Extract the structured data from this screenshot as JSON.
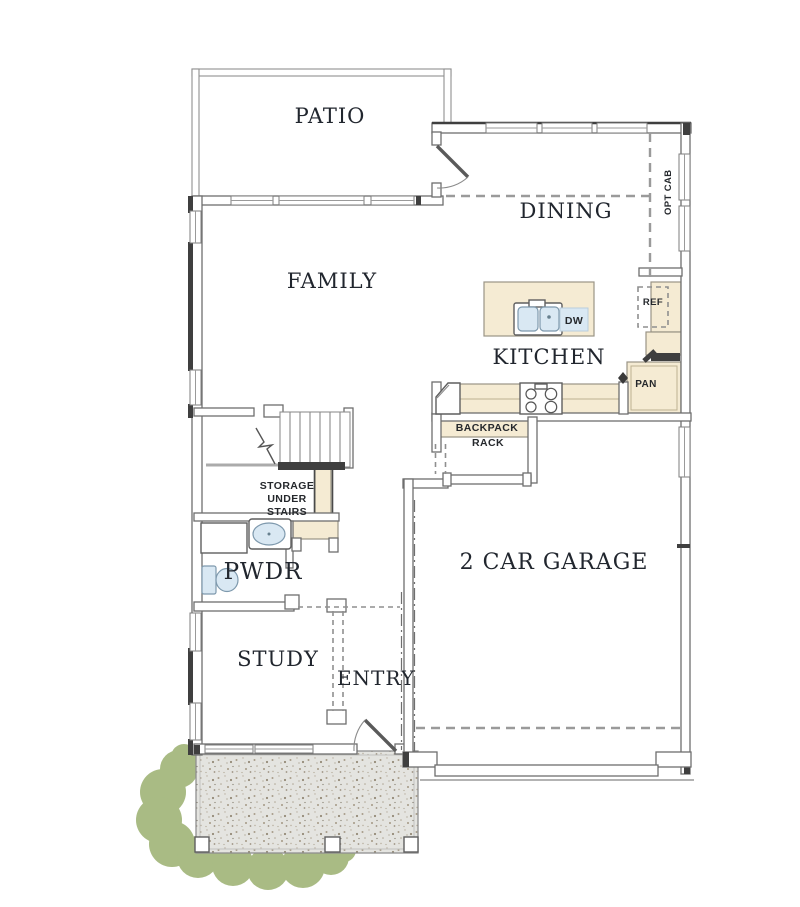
{
  "plan": {
    "rooms": {
      "patio": "PATIO",
      "dining": "DINING",
      "family": "FAMILY",
      "kitchen": "KITCHEN",
      "garage": "2 CAR GARAGE",
      "study": "STUDY",
      "entry": "ENTRY",
      "powder": "PWDR"
    },
    "labels": {
      "storage_line1": "STORAGE",
      "storage_line2": "UNDER",
      "storage_line3": "STAIRS",
      "backpack_line1": "BACKPACK",
      "backpack_line2": "RACK",
      "ref": "REF",
      "pan": "PAN",
      "dw": "DW",
      "opt_cab": "OPT CAB"
    },
    "colors": {
      "cabinet_fill": "#f5ebd3",
      "fixture_blue": "#d9e8f3",
      "porch_concrete": "#e4e4e0",
      "shrub_green": "#a9bb84",
      "wall_dark": "#3f3f3f",
      "label_color": "#21262e"
    }
  }
}
